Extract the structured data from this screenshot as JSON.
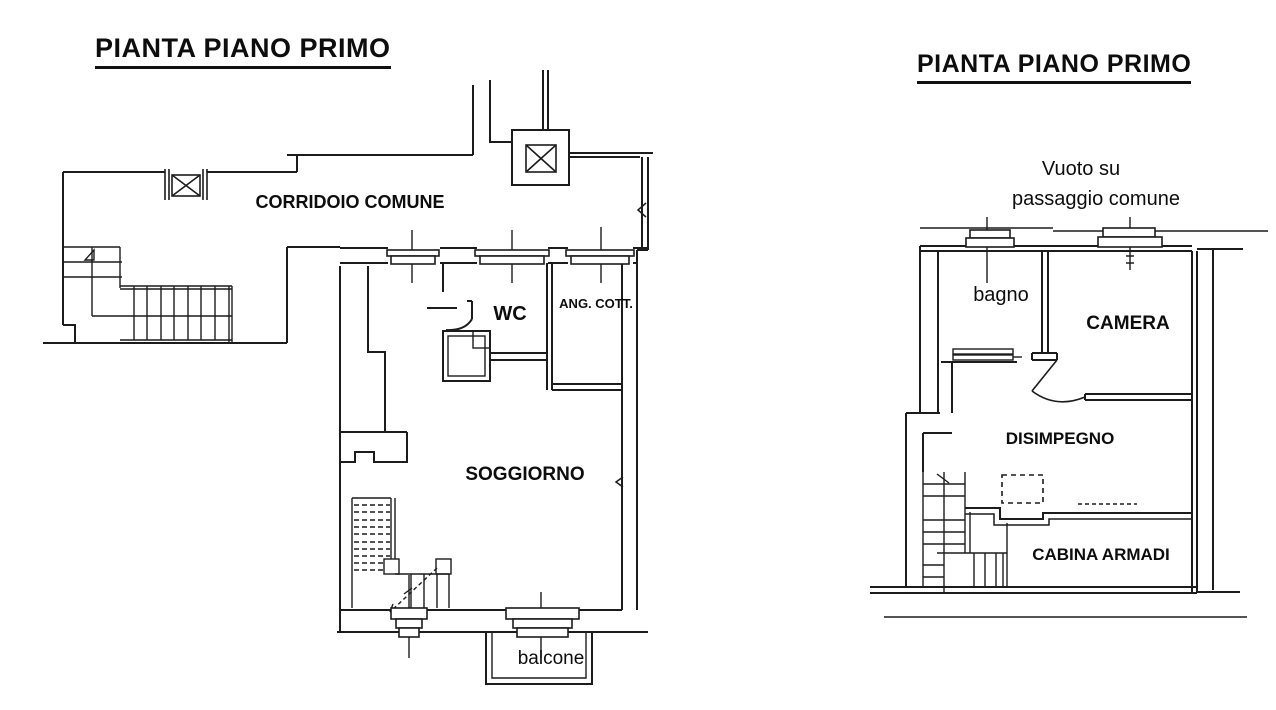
{
  "colors": {
    "line": "#1c1c1c",
    "background": "#ffffff",
    "text": "#0d0d0d"
  },
  "left_plan": {
    "title": "PIANTA PIANO PRIMO",
    "labels": {
      "corridor": "CORRIDOIO COMUNE",
      "wc": "WC",
      "ang_cott": "ANG. COTT.",
      "soggiorno": "SOGGIORNO",
      "balcone": "balcone"
    }
  },
  "right_plan": {
    "title": "PIANTA PIANO PRIMO",
    "labels": {
      "void_line1": "Vuoto su",
      "void_line2": "passaggio comune",
      "bagno": "bagno",
      "camera": "CAMERA",
      "disimpegno": "DISIMPEGNO",
      "cabina_armadi": "CABINA ARMADI"
    }
  }
}
